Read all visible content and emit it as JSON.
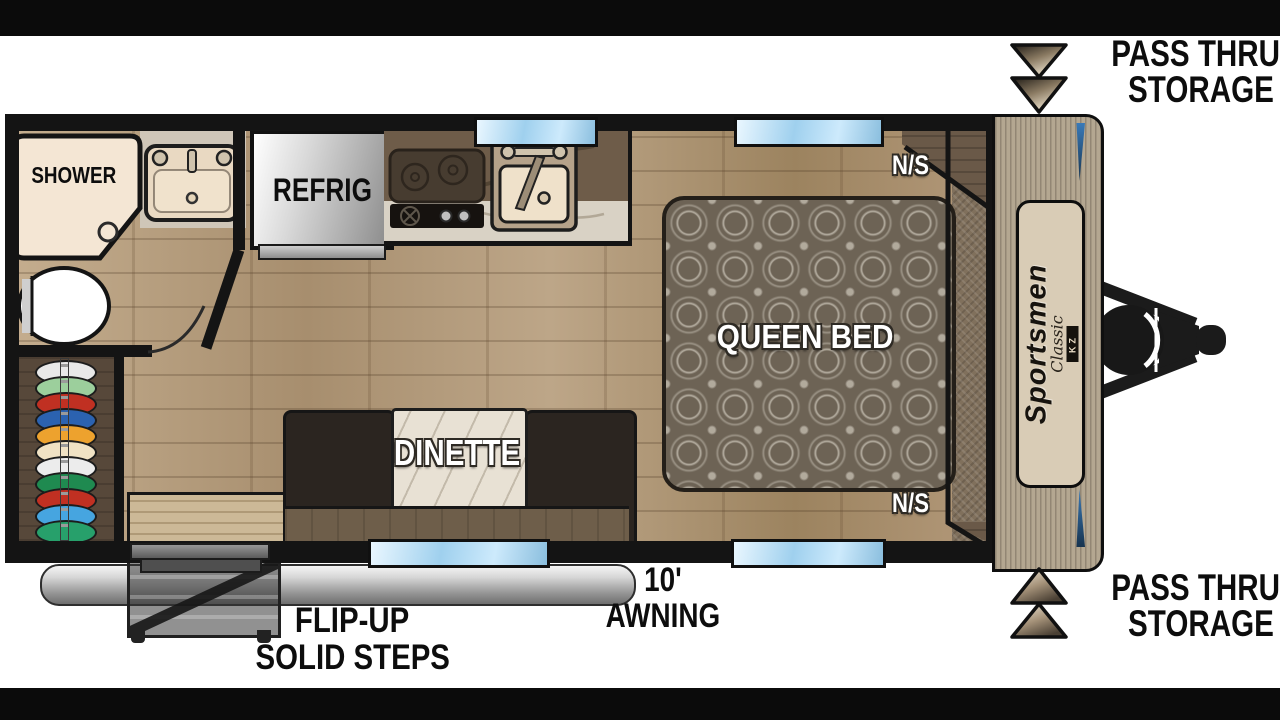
{
  "meta": {
    "type": "travel-trailer floor plan",
    "background": "#ffffff",
    "border_bar_color": "#0b0b0b"
  },
  "labels": {
    "shower": "SHOWER",
    "refrig": "REFRIG",
    "dinette": "DINETTE",
    "queen_bed": "QUEEN BED",
    "ns": "N/S",
    "awning_length": "10'",
    "awning": "AWNING",
    "flip_up": "FLIP-UP",
    "solid_steps": "SOLID STEPS",
    "pass_thru_line1": "PASS THRU",
    "pass_thru_line2": "STORAGE"
  },
  "branding": {
    "name": "Sportsmen",
    "series": "Classic",
    "maker": "KZ"
  },
  "colors": {
    "accent_blue": "#2d6ba8",
    "cap_tan": "#b4a791",
    "floor_wood": "#b19a7c",
    "bed_fabric": "#6d6355",
    "shower_cream": "#f4e6d4",
    "storage_carpet": "#80705c",
    "label_black": "#0d0d0d",
    "label_white": "#ffffff"
  },
  "wardrobe": {
    "clothes_colors": [
      "#e8e8e8",
      "#9ccf9c",
      "#c03022",
      "#2b62b0",
      "#eda22e",
      "#f0e2c4",
      "#ececec",
      "#1f8a50",
      "#c03022",
      "#46a5e0",
      "#27a06b"
    ]
  },
  "features": {
    "windows": [
      "kitchen top window",
      "bedroom top window",
      "dinette bottom window",
      "bedroom bottom window"
    ],
    "fixtures": [
      "shower",
      "bathroom sink",
      "toilet",
      "refrigerator",
      "cooktop",
      "kitchen sink",
      "wardrobe",
      "dinette",
      "queen bed",
      "nightstands",
      "pass-thru storage",
      "awning",
      "flip-up solid steps",
      "a-frame hitch",
      "propane tank"
    ]
  }
}
